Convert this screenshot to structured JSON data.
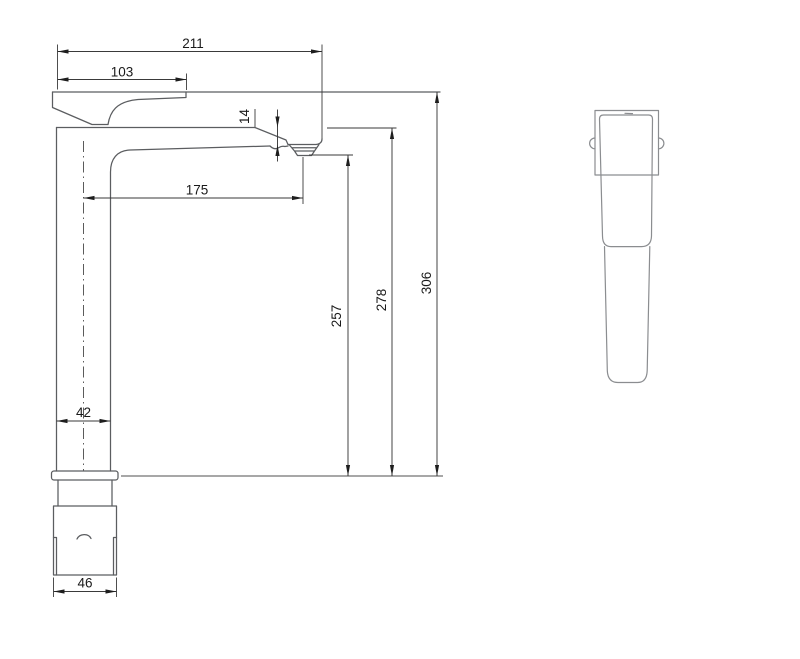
{
  "dimensions": {
    "overall_length": "211",
    "handle_length": "103",
    "spout_drop": "14",
    "spout_reach": "175",
    "outlet_height": "257",
    "rim_height": "278",
    "overall_height": "306",
    "body_width": "42",
    "base_width": "46"
  },
  "colors": {
    "background": "#ffffff",
    "outline_front_view": "#5b5d60",
    "outline_side_view": "#8b8d90",
    "dimension_lines": "#3a3a3a",
    "dimension_text": "#1a1a1a"
  }
}
